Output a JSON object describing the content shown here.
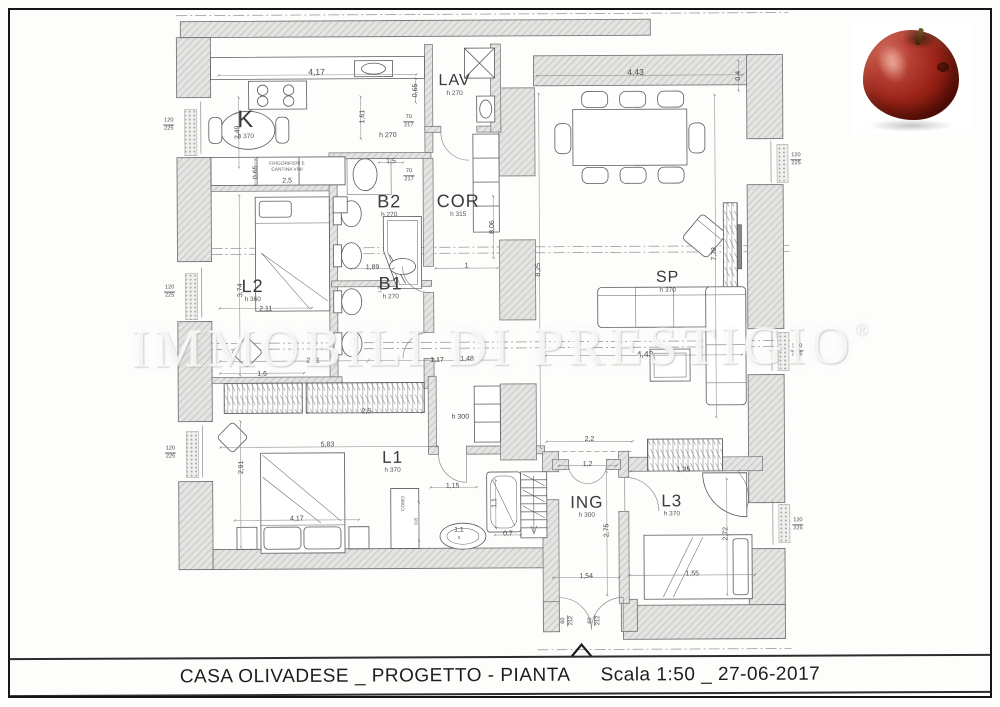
{
  "caption": {
    "title": "CASA OLIVADESE _ PROGETTO - PIANTA",
    "scale_date": "Scala 1:50 _ 27-06-2017"
  },
  "watermark": {
    "text": "IMMOBILI DI PRESTIGIO",
    "mark": "®"
  },
  "rooms": [
    {
      "n": "K",
      "h": "h 370",
      "x": 247,
      "y": 123,
      "s": 24
    },
    {
      "n": "LAV",
      "h": "h 270",
      "x": 456,
      "y": 85,
      "s": 16
    },
    {
      "n": "B2",
      "h": "h 270",
      "x": 390,
      "y": 205,
      "s": 18
    },
    {
      "n": "COR",
      "h": "h 315",
      "x": 459,
      "y": 205,
      "s": 18
    },
    {
      "n": "B1",
      "h": "h 270",
      "x": 391,
      "y": 287,
      "s": 18
    },
    {
      "n": "L2",
      "h": "h 360",
      "x": 253,
      "y": 289,
      "s": 18
    },
    {
      "n": "SP",
      "h": "h 370",
      "x": 668,
      "y": 283,
      "s": 16
    },
    {
      "n": "L1",
      "h": "h 370",
      "x": 392,
      "y": 461,
      "s": 17
    },
    {
      "n": "ING",
      "h": "h 300",
      "x": 586,
      "y": 507,
      "s": 17
    },
    {
      "n": "L3",
      "h": "h 370",
      "x": 671,
      "y": 506,
      "s": 17
    }
  ],
  "dims": [
    {
      "t": "4,17",
      "x": 318,
      "y": 71
    },
    {
      "t": "4,43",
      "x": 637,
      "y": 73
    },
    {
      "t": "0,4",
      "x": 740,
      "y": 77,
      "r": 1,
      "c": 1
    },
    {
      "t": "1,61",
      "x": 364,
      "y": 116,
      "r": 1,
      "c": 1
    },
    {
      "t": "0,65",
      "x": 417,
      "y": 90,
      "r": 1,
      "c": 1
    },
    {
      "t": "h 270",
      "x": 389,
      "y": 135,
      "c": 1
    },
    {
      "t": "1,5",
      "x": 392,
      "y": 161,
      "c": 1
    },
    {
      "t": "2,49",
      "x": 239,
      "y": 131,
      "r": 1,
      "c": 1
    },
    {
      "t": "0,65",
      "x": 257,
      "y": 171,
      "r": 1,
      "c": 1
    },
    {
      "t": "FRIGORIFERI E",
      "x": 288,
      "y": 164,
      "c": 2
    },
    {
      "t": "CANTINA VINI",
      "x": 288,
      "y": 170,
      "c": 2
    },
    {
      "t": "2,5",
      "x": 288,
      "y": 180,
      "c": 1
    },
    {
      "t": "3,74",
      "x": 241,
      "y": 289,
      "r": 1,
      "c": 1
    },
    {
      "t": "2,11",
      "x": 266,
      "y": 308,
      "c": 1
    },
    {
      "t": "1,89",
      "x": 373,
      "y": 267,
      "c": 1
    },
    {
      "t": "1,3",
      "x": 382,
      "y": 289,
      "r": 1,
      "c": 2
    },
    {
      "t": "1",
      "x": 467,
      "y": 266,
      "c": 1
    },
    {
      "t": "8,06",
      "x": 493,
      "y": 227,
      "r": 1,
      "c": 1
    },
    {
      "t": "1,6",
      "x": 262,
      "y": 373,
      "c": 1
    },
    {
      "t": "2,91",
      "x": 313,
      "y": 360,
      "c": 1
    },
    {
      "t": "1,17",
      "x": 437,
      "y": 360,
      "c": 1
    },
    {
      "t": "1,48",
      "x": 467,
      "y": 359,
      "c": 1
    },
    {
      "t": "2,5",
      "x": 366,
      "y": 411,
      "c": 1
    },
    {
      "t": "h 300",
      "x": 460,
      "y": 417,
      "c": 1
    },
    {
      "t": "8,25",
      "x": 539,
      "y": 270,
      "r": 1,
      "c": 1
    },
    {
      "t": "7,78",
      "x": 715,
      "y": 255,
      "r": 1,
      "c": 1
    },
    {
      "t": "4,43",
      "x": 645,
      "y": 355
    },
    {
      "t": "5,83",
      "x": 327,
      "y": 444,
      "c": 1
    },
    {
      "t": "2,91",
      "x": 241,
      "y": 466,
      "r": 1,
      "c": 1
    },
    {
      "t": "4,17",
      "x": 296,
      "y": 518,
      "c": 1
    },
    {
      "t": "1,15",
      "x": 452,
      "y": 486,
      "c": 1
    },
    {
      "t": "COMO",
      "x": 404,
      "y": 503,
      "r": 1,
      "c": 2
    },
    {
      "t": "0,8",
      "x": 417,
      "y": 521,
      "r": 1,
      "c": 2
    },
    {
      "t": "1,1",
      "x": 458,
      "y": 530,
      "c": 1
    },
    {
      "t": "o",
      "x": 458,
      "y": 539,
      "c": 2
    },
    {
      "t": "1,1",
      "x": 494,
      "y": 503,
      "r": 1,
      "c": 1
    },
    {
      "t": "0,7",
      "x": 507,
      "y": 534,
      "c": 1
    },
    {
      "t": "2,2",
      "x": 589,
      "y": 440,
      "c": 1
    },
    {
      "t": "1,2",
      "x": 587,
      "y": 465,
      "c": 1
    },
    {
      "t": "2,75",
      "x": 606,
      "y": 531,
      "r": 1,
      "c": 1
    },
    {
      "t": "1,54",
      "x": 585,
      "y": 577,
      "c": 1
    },
    {
      "t": "1,35",
      "x": 683,
      "y": 471,
      "c": 1
    },
    {
      "t": "1,55",
      "x": 691,
      "y": 575,
      "c": 1
    },
    {
      "t": "2,72",
      "x": 725,
      "y": 535,
      "r": 1,
      "c": 1
    }
  ],
  "fracs": [
    {
      "top": "120",
      "bot": "225",
      "x": 170,
      "y": 123
    },
    {
      "top": "120",
      "bot": "225",
      "x": 170,
      "y": 290
    },
    {
      "top": "120",
      "bot": "225",
      "x": 170,
      "y": 451
    },
    {
      "top": "120",
      "bot": "225",
      "x": 797,
      "y": 161
    },
    {
      "top": "1,10",
      "bot": "2,25",
      "x": 797,
      "y": 352
    },
    {
      "top": "120",
      "bot": "225",
      "x": 797,
      "y": 526
    },
    {
      "top": "70",
      "bot": "217",
      "x": 410,
      "y": 121
    },
    {
      "top": "70",
      "bot": "217",
      "x": 410,
      "y": 175
    },
    {
      "top": "60",
      "bot": "212",
      "x": 566,
      "y": 621,
      "r": 1
    },
    {
      "top": "60",
      "bot": "212",
      "x": 593,
      "y": 621,
      "r": 1
    }
  ]
}
